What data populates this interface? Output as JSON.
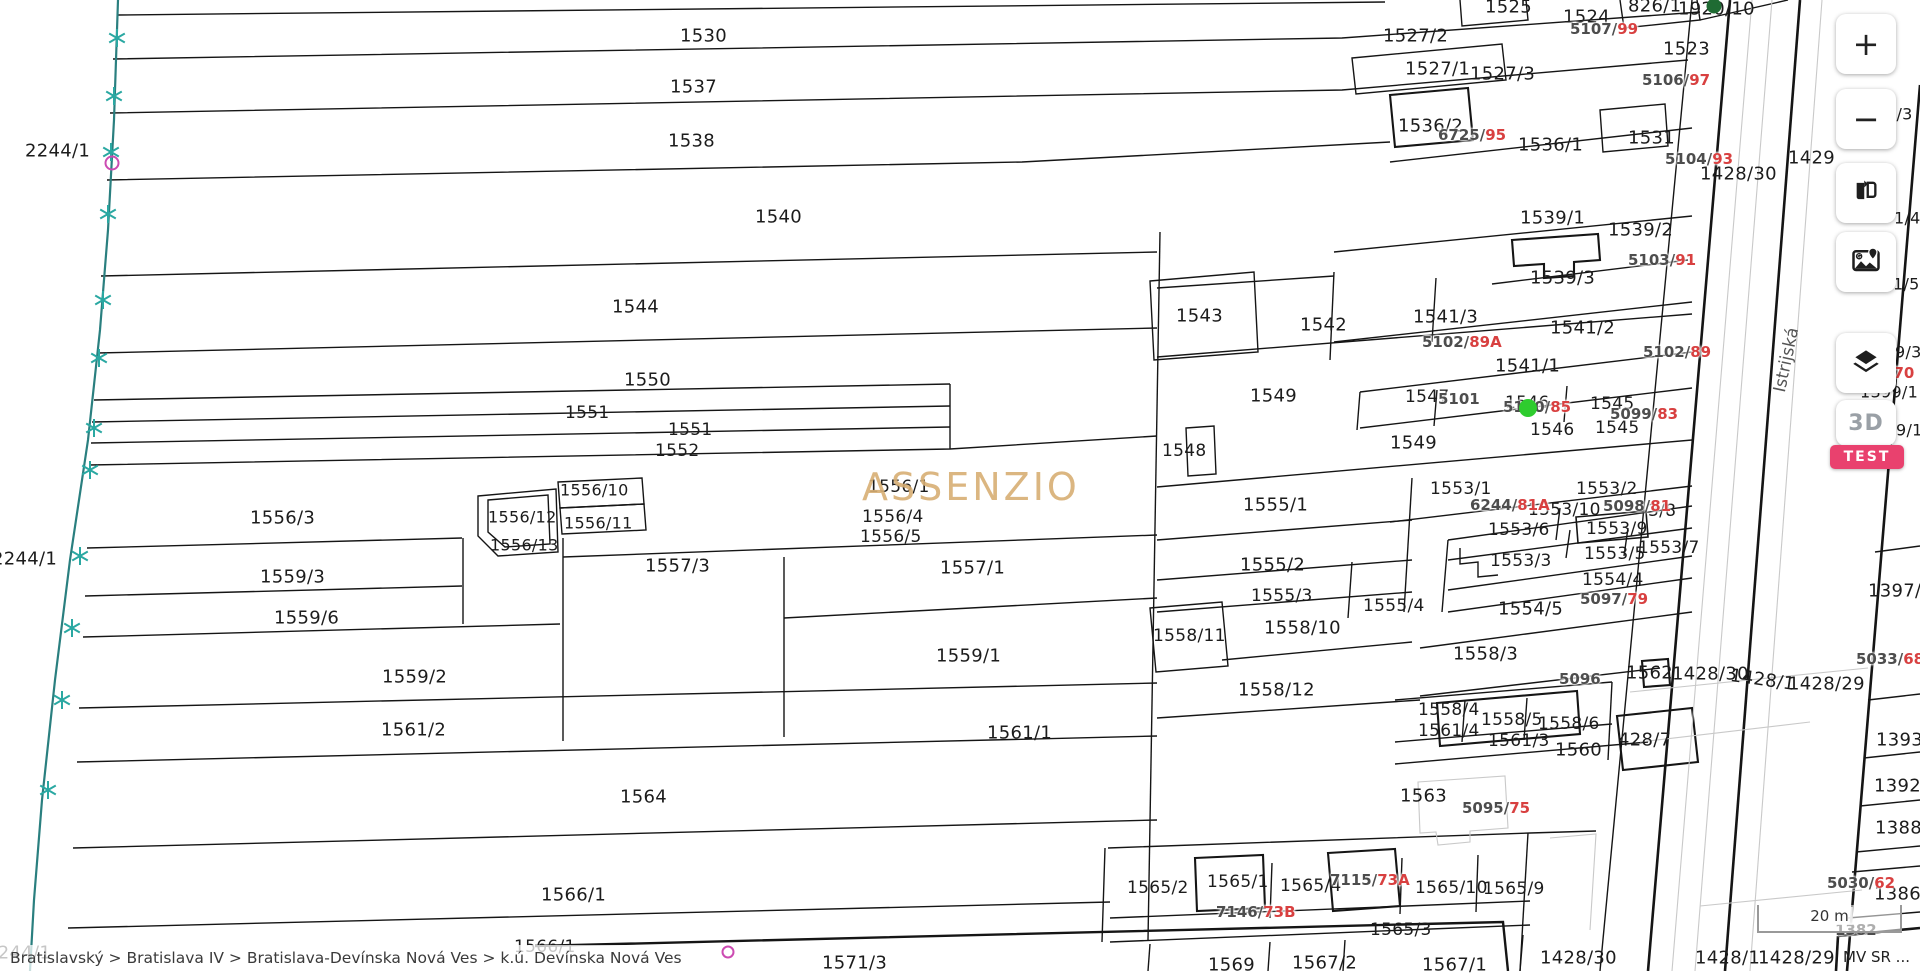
{
  "app": {
    "breadcrumb": "Bratislavský > Bratislava IV > Bratislava-Devínska Nová Ves > k.ú. Devínska Nová Ves",
    "attribution": "MV SR ...",
    "colors": {
      "parcel_label": "#1c1c1c",
      "register_gray": "#4d4d4d",
      "register_red": "#d84040",
      "watermark": "#d8af74",
      "stream": "#2a7f7f",
      "stream_star": "#2aa8a2",
      "marker_green": "#2ecc2e",
      "marker_dark_green": "#1f6b33",
      "marker_magenta": "#cc4bb2",
      "badge_bg": "#e9416e",
      "road_label": "#555555"
    }
  },
  "toolbar": {
    "zoom_in_label": "+",
    "zoom_out_label": "−",
    "three_d_label": "3D",
    "test_badge_label": "TEST"
  },
  "map": {
    "watermark": "ASSENZIO",
    "street_label": "Istrijská",
    "scale_bar_label": "20 m",
    "parcel_labels": [
      {
        "t": "2244/1",
        "x": 25,
        "y": 151
      },
      {
        "t": "2244/1",
        "x": -8,
        "y": 559
      },
      {
        "t": "2244/1",
        "x": -14,
        "y": 953
      },
      {
        "t": "1530",
        "x": 680,
        "y": 36
      },
      {
        "t": "1537",
        "x": 670,
        "y": 87
      },
      {
        "t": "1538",
        "x": 668,
        "y": 141
      },
      {
        "t": "1540",
        "x": 755,
        "y": 217
      },
      {
        "t": "1544",
        "x": 612,
        "y": 307
      },
      {
        "t": "1550",
        "x": 624,
        "y": 380
      },
      {
        "t": "1551",
        "x": 565,
        "y": 413,
        "s": 17
      },
      {
        "t": "1551",
        "x": 668,
        "y": 430,
        "s": 17
      },
      {
        "t": "1552",
        "x": 655,
        "y": 451,
        "s": 17
      },
      {
        "t": "1556/3",
        "x": 250,
        "y": 518
      },
      {
        "t": "1556/10",
        "x": 560,
        "y": 490,
        "s": 16
      },
      {
        "t": "1556/12",
        "x": 488,
        "y": 517,
        "s": 16
      },
      {
        "t": "1556/11",
        "x": 564,
        "y": 523,
        "s": 16
      },
      {
        "t": "1556/13",
        "x": 490,
        "y": 545,
        "s": 16
      },
      {
        "t": "1556/1",
        "x": 868,
        "y": 487,
        "s": 17
      },
      {
        "t": "1556/4",
        "x": 862,
        "y": 517,
        "s": 17
      },
      {
        "t": "1556/5",
        "x": 860,
        "y": 537,
        "s": 17
      },
      {
        "t": "1557/3",
        "x": 645,
        "y": 566
      },
      {
        "t": "1557/1",
        "x": 940,
        "y": 568
      },
      {
        "t": "1559/3",
        "x": 260,
        "y": 577
      },
      {
        "t": "1559/6",
        "x": 274,
        "y": 618
      },
      {
        "t": "1559/2",
        "x": 382,
        "y": 677
      },
      {
        "t": "1559/1",
        "x": 936,
        "y": 656
      },
      {
        "t": "1561/2",
        "x": 381,
        "y": 730
      },
      {
        "t": "1561/1",
        "x": 987,
        "y": 733
      },
      {
        "t": "1564",
        "x": 620,
        "y": 797
      },
      {
        "t": "1566/1",
        "x": 541,
        "y": 895
      },
      {
        "t": "1566/1",
        "x": 514,
        "y": 947,
        "s": 17
      },
      {
        "t": "1571/3",
        "x": 822,
        "y": 963
      },
      {
        "t": "1569",
        "x": 1208,
        "y": 965
      },
      {
        "t": "1567/2",
        "x": 1292,
        "y": 963
      },
      {
        "t": "1567/1",
        "x": 1422,
        "y": 965
      },
      {
        "t": "1565/2",
        "x": 1127,
        "y": 888,
        "s": 17
      },
      {
        "t": "1565/1",
        "x": 1207,
        "y": 882,
        "s": 17
      },
      {
        "t": "1565/4",
        "x": 1280,
        "y": 886,
        "s": 17
      },
      {
        "t": "1565/10",
        "x": 1415,
        "y": 888,
        "s": 17
      },
      {
        "t": "1565/9",
        "x": 1483,
        "y": 889,
        "s": 17
      },
      {
        "t": "1565/3",
        "x": 1370,
        "y": 930,
        "s": 17
      },
      {
        "t": "1563",
        "x": 1400,
        "y": 796
      },
      {
        "t": "1543",
        "x": 1176,
        "y": 316
      },
      {
        "t": "1542",
        "x": 1300,
        "y": 325
      },
      {
        "t": "1541/3",
        "x": 1413,
        "y": 317
      },
      {
        "t": "1541/2",
        "x": 1550,
        "y": 328
      },
      {
        "t": "1541/1",
        "x": 1495,
        "y": 366
      },
      {
        "t": "1549",
        "x": 1250,
        "y": 396
      },
      {
        "t": "1549",
        "x": 1390,
        "y": 443
      },
      {
        "t": "1548",
        "x": 1162,
        "y": 451,
        "s": 17
      },
      {
        "t": "1547",
        "x": 1405,
        "y": 397,
        "s": 17
      },
      {
        "t": "1546",
        "x": 1505,
        "y": 403,
        "s": 17
      },
      {
        "t": "1545",
        "x": 1590,
        "y": 404,
        "s": 17
      },
      {
        "t": "1546",
        "x": 1530,
        "y": 430,
        "s": 17
      },
      {
        "t": "1545",
        "x": 1595,
        "y": 428,
        "s": 17
      },
      {
        "t": "1539/1",
        "x": 1520,
        "y": 218
      },
      {
        "t": "1539/2",
        "x": 1608,
        "y": 230
      },
      {
        "t": "1539/3",
        "x": 1530,
        "y": 278
      },
      {
        "t": "1536/2",
        "x": 1398,
        "y": 126
      },
      {
        "t": "1536/1",
        "x": 1518,
        "y": 145
      },
      {
        "t": "1531",
        "x": 1628,
        "y": 138
      },
      {
        "t": "1527/2",
        "x": 1383,
        "y": 36
      },
      {
        "t": "1527/1",
        "x": 1405,
        "y": 69
      },
      {
        "t": "1527/3",
        "x": 1470,
        "y": 74
      },
      {
        "t": "1525",
        "x": 1485,
        "y": 7
      },
      {
        "t": "1524",
        "x": 1563,
        "y": 17
      },
      {
        "t": "1523",
        "x": 1663,
        "y": 49
      },
      {
        "t": "826/1",
        "x": 1628,
        "y": 6
      },
      {
        "t": "1920/10",
        "x": 1678,
        "y": 9
      },
      {
        "t": "1428/30",
        "x": 1700,
        "y": 174
      },
      {
        "t": "1553/1",
        "x": 1430,
        "y": 489,
        "s": 17
      },
      {
        "t": "1553/2",
        "x": 1576,
        "y": 489,
        "s": 17
      },
      {
        "t": "1553/10",
        "x": 1528,
        "y": 510,
        "s": 17
      },
      {
        "t": "3/8",
        "x": 1648,
        "y": 511,
        "s": 17
      },
      {
        "t": "1553/6",
        "x": 1488,
        "y": 530,
        "s": 17
      },
      {
        "t": "1553/9",
        "x": 1586,
        "y": 529,
        "s": 17
      },
      {
        "t": "1553/5",
        "x": 1584,
        "y": 554,
        "s": 17
      },
      {
        "t": "1553/7",
        "x": 1638,
        "y": 548,
        "s": 17
      },
      {
        "t": "1553/3",
        "x": 1490,
        "y": 561,
        "s": 17
      },
      {
        "t": "1554/4",
        "x": 1582,
        "y": 580,
        "s": 17
      },
      {
        "t": "1554/5",
        "x": 1498,
        "y": 609
      },
      {
        "t": "1555/4",
        "x": 1363,
        "y": 606,
        "s": 17
      },
      {
        "t": "1555/3",
        "x": 1251,
        "y": 596,
        "s": 17
      },
      {
        "t": "1555/2",
        "x": 1240,
        "y": 565
      },
      {
        "t": "1555/1",
        "x": 1243,
        "y": 505
      },
      {
        "t": "1558/11",
        "x": 1153,
        "y": 636,
        "s": 17
      },
      {
        "t": "1558/10",
        "x": 1264,
        "y": 628
      },
      {
        "t": "1558/12",
        "x": 1238,
        "y": 690
      },
      {
        "t": "1558/3",
        "x": 1453,
        "y": 654
      },
      {
        "t": "1558/4",
        "x": 1418,
        "y": 710,
        "s": 17
      },
      {
        "t": "1558/5",
        "x": 1481,
        "y": 720,
        "s": 17
      },
      {
        "t": "1558/6",
        "x": 1538,
        "y": 724,
        "s": 17
      },
      {
        "t": "1561/4",
        "x": 1418,
        "y": 731,
        "s": 17
      },
      {
        "t": "1561/3",
        "x": 1488,
        "y": 741,
        "s": 17
      },
      {
        "t": "1560",
        "x": 1555,
        "y": 750
      },
      {
        "t": "428/7",
        "x": 1618,
        "y": 740
      },
      {
        "t": "1562",
        "x": 1626,
        "y": 673
      },
      {
        "t": "1428/30",
        "x": 1672,
        "y": 674
      },
      {
        "t": "1428/1",
        "x": 1730,
        "y": 680,
        "r": 8
      },
      {
        "t": "1428/29",
        "x": 1788,
        "y": 684
      },
      {
        "t": "1429",
        "x": 1788,
        "y": 158
      },
      {
        "t": "1397/1",
        "x": 1868,
        "y": 591
      },
      {
        "t": "1393",
        "x": 1876,
        "y": 740
      },
      {
        "t": "1392",
        "x": 1874,
        "y": 786
      },
      {
        "t": "1388",
        "x": 1875,
        "y": 828
      },
      {
        "t": "1386",
        "x": 1874,
        "y": 894
      },
      {
        "t": "1428/30",
        "x": 1540,
        "y": 958
      },
      {
        "t": "1428/1",
        "x": 1695,
        "y": 958
      },
      {
        "t": "1428/29",
        "x": 1758,
        "y": 958
      },
      {
        "t": "4/3",
        "x": 1886,
        "y": 114,
        "s": 16
      },
      {
        "t": "1/4",
        "x": 1894,
        "y": 218,
        "s": 16
      },
      {
        "t": "1/5",
        "x": 1893,
        "y": 284,
        "s": 16
      },
      {
        "t": "9/3",
        "x": 1895,
        "y": 352,
        "s": 16
      },
      {
        "t": "1399/1",
        "x": 1860,
        "y": 392,
        "s": 16
      },
      {
        "t": "9/1",
        "x": 1896,
        "y": 430,
        "s": 16
      }
    ],
    "register_labels": [
      {
        "g": "5107/",
        "r": "99",
        "x": 1570,
        "y": 29
      },
      {
        "g": "5106/",
        "r": "97",
        "x": 1642,
        "y": 80
      },
      {
        "g": "6725/",
        "r": "95",
        "x": 1438,
        "y": 135
      },
      {
        "g": "5104/",
        "r": "93",
        "x": 1665,
        "y": 159
      },
      {
        "g": "5103/",
        "r": "91",
        "x": 1628,
        "y": 260
      },
      {
        "g": "5102/",
        "r": "89A",
        "x": 1422,
        "y": 342
      },
      {
        "g": "5102/",
        "r": "89",
        "x": 1643,
        "y": 352
      },
      {
        "g": "5101",
        "r": "",
        "x": 1438,
        "y": 399
      },
      {
        "g": "5100/",
        "r": "85",
        "x": 1503,
        "y": 407
      },
      {
        "g": "5099/",
        "r": "83",
        "x": 1610,
        "y": 414
      },
      {
        "g": "6244/",
        "r": "81A",
        "x": 1470,
        "y": 505
      },
      {
        "g": "5098/",
        "r": "81",
        "x": 1603,
        "y": 506
      },
      {
        "g": "5097/",
        "r": "79",
        "x": 1580,
        "y": 599
      },
      {
        "g": "5096",
        "r": "",
        "x": 1559,
        "y": 679
      },
      {
        "g": "5095/",
        "r": "75",
        "x": 1462,
        "y": 808
      },
      {
        "g": "7115/",
        "r": "73A",
        "x": 1330,
        "y": 880
      },
      {
        "g": "7146/",
        "r": "73B",
        "x": 1216,
        "y": 912
      },
      {
        "g": "5033/",
        "r": "68",
        "x": 1856,
        "y": 659
      },
      {
        "g": "5030/",
        "r": "62",
        "x": 1827,
        "y": 883
      },
      {
        "g": "1382",
        "r": "",
        "x": 1835,
        "y": 930
      },
      {
        "g": "",
        "r": "/70",
        "x": 1888,
        "y": 373
      }
    ],
    "stream_stars": [
      [
        117,
        38
      ],
      [
        114,
        96
      ],
      [
        111,
        152
      ],
      [
        108,
        214
      ],
      [
        103,
        300
      ],
      [
        99,
        358
      ],
      [
        94,
        428
      ],
      [
        90,
        470
      ],
      [
        80,
        556
      ],
      [
        72,
        628
      ],
      [
        62,
        700
      ],
      [
        48,
        790
      ]
    ],
    "markers": [
      {
        "name": "selected-point-marker",
        "x": 1528,
        "y": 408,
        "d": 18,
        "fill": "#2ecc2e",
        "border": "none"
      },
      {
        "name": "point-marker-dark",
        "x": 1714,
        "y": 6,
        "d": 15,
        "fill": "#1f6b33",
        "border": "none"
      },
      {
        "name": "survey-point-marker",
        "x": 112,
        "y": 163,
        "d": 11,
        "fill": "transparent",
        "border": "2px solid #cc4bb2"
      },
      {
        "name": "survey-point-marker",
        "x": 728,
        "y": 952,
        "d": 9,
        "fill": "transparent",
        "border": "2px solid #cc4bb2"
      }
    ]
  }
}
